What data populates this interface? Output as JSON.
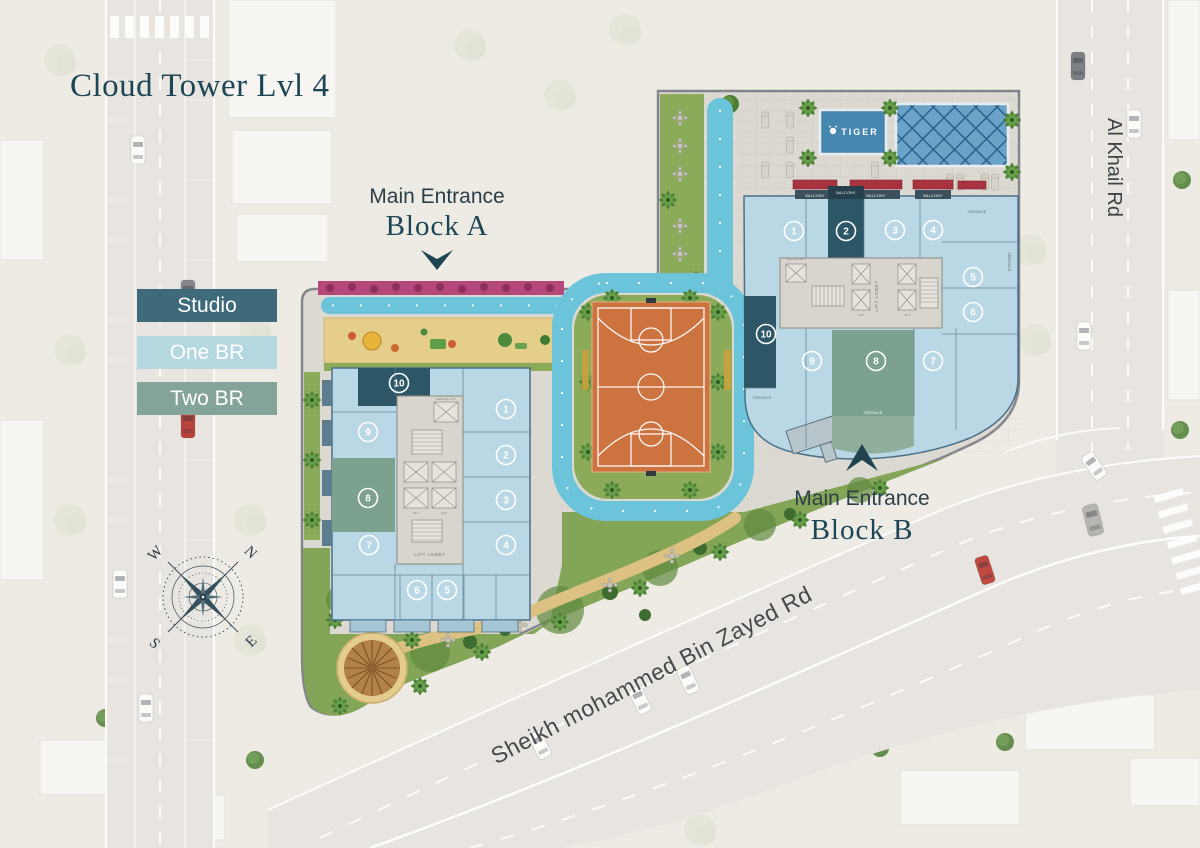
{
  "title": {
    "text": "Cloud Tower Lvl 4",
    "color": "#1c4656"
  },
  "legend": {
    "items": [
      {
        "id": "studio",
        "label": "Studio",
        "color": "#3e6a7a",
        "text_color": "#ffffff"
      },
      {
        "id": "one_br",
        "label": "One BR",
        "color": "#b5d7e0",
        "text_color": "#ffffff"
      },
      {
        "id": "two_br",
        "label": "Two BR",
        "color": "#84a399",
        "text_color": "#ffffff"
      }
    ]
  },
  "entrances": {
    "block_a": {
      "line1": "Main Entrance",
      "line2": "Block A",
      "arrow": "down"
    },
    "block_b": {
      "line1": "Main Entrance",
      "line2": "Block B",
      "arrow": "up"
    }
  },
  "roads": {
    "al_khail": {
      "label": "Al Khail Rd"
    },
    "sheikh_mohammed": {
      "label": "Sheikh mohammed Bin Zayed Rd"
    }
  },
  "compass": {
    "n": "N",
    "e": "E",
    "s": "S",
    "w": "W"
  },
  "pool": {
    "brand": "TIGER"
  },
  "block_a": {
    "name": "Block A",
    "core": {
      "lobby": "LIFT LOBBY",
      "lift": "LIFT",
      "service_lift": "SERVICE LIFT"
    },
    "units": [
      {
        "n": "1",
        "x": 506,
        "y": 409,
        "type": "one_br"
      },
      {
        "n": "2",
        "x": 506,
        "y": 455,
        "type": "one_br"
      },
      {
        "n": "3",
        "x": 506,
        "y": 500,
        "type": "one_br"
      },
      {
        "n": "4",
        "x": 506,
        "y": 545,
        "type": "one_br"
      },
      {
        "n": "5",
        "x": 447,
        "y": 590,
        "type": "one_br"
      },
      {
        "n": "6",
        "x": 417,
        "y": 590,
        "type": "one_br"
      },
      {
        "n": "7",
        "x": 369,
        "y": 545,
        "type": "one_br"
      },
      {
        "n": "8",
        "x": 368,
        "y": 498,
        "type": "two_br"
      },
      {
        "n": "9",
        "x": 368,
        "y": 432,
        "type": "one_br"
      },
      {
        "n": "10",
        "x": 399,
        "y": 383,
        "type": "studio"
      }
    ]
  },
  "block_b": {
    "name": "Block B",
    "core": {
      "lobby": "LIFT LOBBY",
      "lift": "LIFT",
      "service_lift": "SERVICE LIFT"
    },
    "labels": {
      "balcony": "BALCONY",
      "terrace": "TERRACE"
    },
    "units": [
      {
        "n": "1",
        "x": 794,
        "y": 231,
        "type": "one_br"
      },
      {
        "n": "2",
        "x": 846,
        "y": 231,
        "type": "studio"
      },
      {
        "n": "3",
        "x": 895,
        "y": 230,
        "type": "one_br"
      },
      {
        "n": "4",
        "x": 933,
        "y": 230,
        "type": "one_br"
      },
      {
        "n": "5",
        "x": 973,
        "y": 277,
        "type": "one_br"
      },
      {
        "n": "6",
        "x": 973,
        "y": 312,
        "type": "one_br"
      },
      {
        "n": "7",
        "x": 933,
        "y": 361,
        "type": "one_br"
      },
      {
        "n": "8",
        "x": 876,
        "y": 361,
        "type": "two_br"
      },
      {
        "n": "9",
        "x": 812,
        "y": 361,
        "type": "one_br"
      },
      {
        "n": "10",
        "x": 766,
        "y": 334,
        "type": "studio"
      }
    ]
  },
  "colors": {
    "studio": "#2d5767",
    "one_br": "#b9d7e4",
    "two_br": "#7ca28f",
    "track": "#6cc4db",
    "court": "#cd7340",
    "lawn": "#83a557",
    "sand": "#e5cd8a",
    "pool": "#4687b0",
    "pool_lattice": "#6ba3c8",
    "road": "#e8e5e0",
    "site": "#dcd9d2",
    "background": "#edebe4",
    "accent_dark": "#1c4656"
  }
}
